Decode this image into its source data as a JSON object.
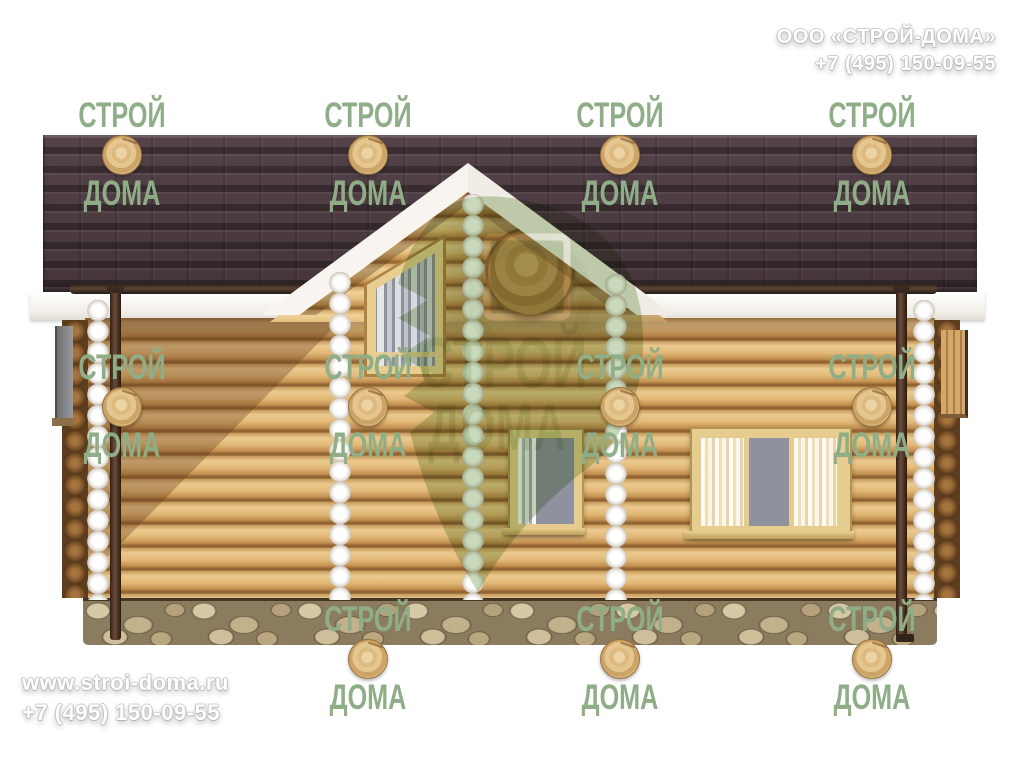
{
  "header": {
    "company": "ООО «СТРОЙ-ДОМА»",
    "phone": "+7 (495) 150-09-55"
  },
  "footer": {
    "website": "www.stroi-doma.ru",
    "phone": "+7 (495) 150-09-55"
  },
  "watermark": {
    "word_top": "СТРОЙ",
    "word_bottom": "ДОМА",
    "logo_word_top": "СТРОЙ",
    "logo_word_bottom": "ДОМА",
    "color": "#8fae88"
  },
  "scene": {
    "subject": "Front elevation render of a single-storey wooden log house with a central gable, dark tiled roof, log walls, four windows and a rubble stone foundation",
    "colors": {
      "roof": "#4a3a3e",
      "log_light": "#e2b877",
      "log_gap": "#8a5c2e",
      "trim_white": "#f5f2ec",
      "window_frame": "#e6cd8f",
      "glass": "#8f929e",
      "foundation": "#8c7c5f",
      "downpipe": "#4a342a",
      "watermark_green": "#8fae88"
    }
  }
}
